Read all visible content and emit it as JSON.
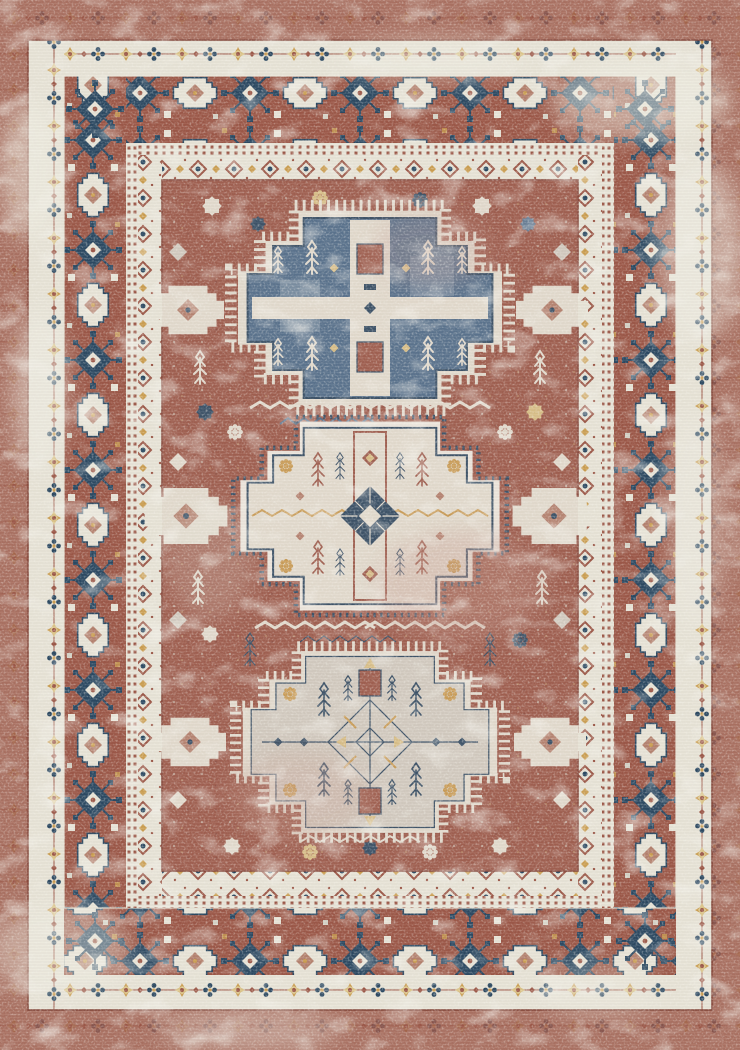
{
  "image": {
    "subject": "Top-down product photo of a rectangular area rug",
    "style": "Vintage distressed Persian / Kazak tribal design with three stepped-cross medallions",
    "condition": "Heavily distressed, washed-out vintage finish with worn cream patches",
    "orientation": "portrait"
  },
  "palette": {
    "rust": "#9d5949",
    "rustDark": "#84463a",
    "rustLight": "#b5826f",
    "pinkFade": "#c9a092",
    "cream": "#e8e4d7",
    "creamBright": "#f2efe6",
    "creamDark": "#d5d2c6",
    "navy": "#2d4a63",
    "blue": "#4e6f8e",
    "blueLight": "#8099ad",
    "gold": "#cc9f52",
    "goldSoft": "#dcc488"
  },
  "rug": {
    "field_color_name": "rust red / terracotta",
    "border_bands": [
      {
        "name": "outer-edge-band",
        "color_name": "rust",
        "description": "plain distressed rust edge"
      },
      {
        "name": "floral-chain-border",
        "color_name": "ivory",
        "description": "small gold and navy flower chain"
      },
      {
        "name": "main-border",
        "color_name": "rust",
        "description": "alternating ivory guls and navy lace rosettes"
      },
      {
        "name": "guard-stripes",
        "color_name": "ivory",
        "description": "double dotted rust guard lines"
      },
      {
        "name": "inner-minor-border",
        "color_name": "ivory",
        "description": "diamond rosette chain"
      }
    ],
    "medallions": [
      {
        "name": "top-medallion",
        "shape": "stepped cross",
        "dominant_color_name": "steel blue",
        "details": "ivory cross bands, rust blocks, ivory plant sprigs"
      },
      {
        "name": "middle-medallion",
        "shape": "stepped cross",
        "dominant_color_name": "ivory",
        "details": "navy checkered center diamond, gold zigzag band, rust lattice column"
      },
      {
        "name": "bottom-medallion",
        "shape": "stepped cross",
        "dominant_color_name": "pale gray",
        "details": "navy diamond outline center, gold rays, navy sprigs, rust crown motifs"
      }
    ],
    "field_motifs": "scattered eight-point stars, rosettes, diamonds, serrated zigzag leaf bands in ivory, navy and gold"
  }
}
